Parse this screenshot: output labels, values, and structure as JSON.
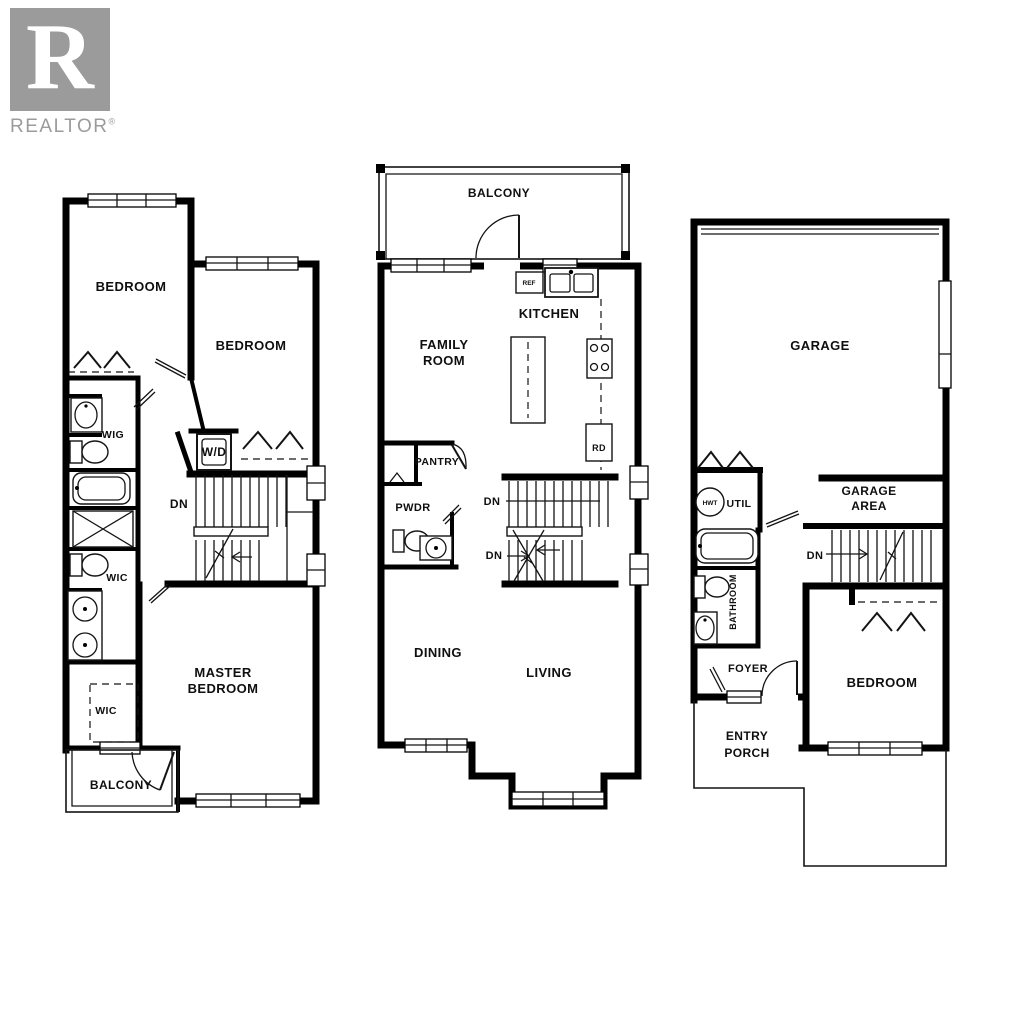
{
  "logo": {
    "letter": "R",
    "brand": "REALTOR",
    "registered": "®",
    "box_color": "#9b9b9b",
    "text_color": "#9b9b9b"
  },
  "colors": {
    "background": "#ffffff",
    "wall": "#000000",
    "line": "#141414",
    "label": "#0f0f0f"
  },
  "plans": {
    "upper": {
      "bedroom_a": "BEDROOM",
      "bedroom_b": "BEDROOM",
      "closet_top": "WIG",
      "washer_dryer": "W/D",
      "stairs_dn": "DN",
      "closet_mid": "WIC",
      "master_line1": "MASTER",
      "master_line2": "BEDROOM",
      "closet_low": "WIC",
      "balcony": "BALCONY",
      "fixtures": [
        "sink",
        "toilet",
        "bathtub",
        "shower",
        "toilet",
        "double-vanity"
      ]
    },
    "main": {
      "balcony": "BALCONY",
      "fridge": "REF",
      "kitchen": "KITCHEN",
      "family_line1": "FAMILY",
      "family_line2": "ROOM",
      "range": "RD",
      "pantry": "PANTRY",
      "powder": "PWDR",
      "dn_upper": "DN",
      "dn_lower": "DN",
      "dining": "DINING",
      "living": "LIVING",
      "fixtures": [
        "refrigerator",
        "double-sink",
        "island",
        "cooktop",
        "toilet",
        "corner-sink"
      ]
    },
    "ground": {
      "garage": "GARAGE",
      "water_heater": "HWT",
      "utility": "UTIL",
      "garage_area_line1": "GARAGE",
      "garage_area_line2": "AREA",
      "stairs_dn": "DN",
      "bathroom": "BATHROOM",
      "foyer": "FOYER",
      "bedroom": "BEDROOM",
      "entry_line1": "ENTRY",
      "entry_line2": "PORCH",
      "fixtures": [
        "hot-water-tank",
        "bathtub",
        "toilet",
        "sink"
      ]
    }
  }
}
